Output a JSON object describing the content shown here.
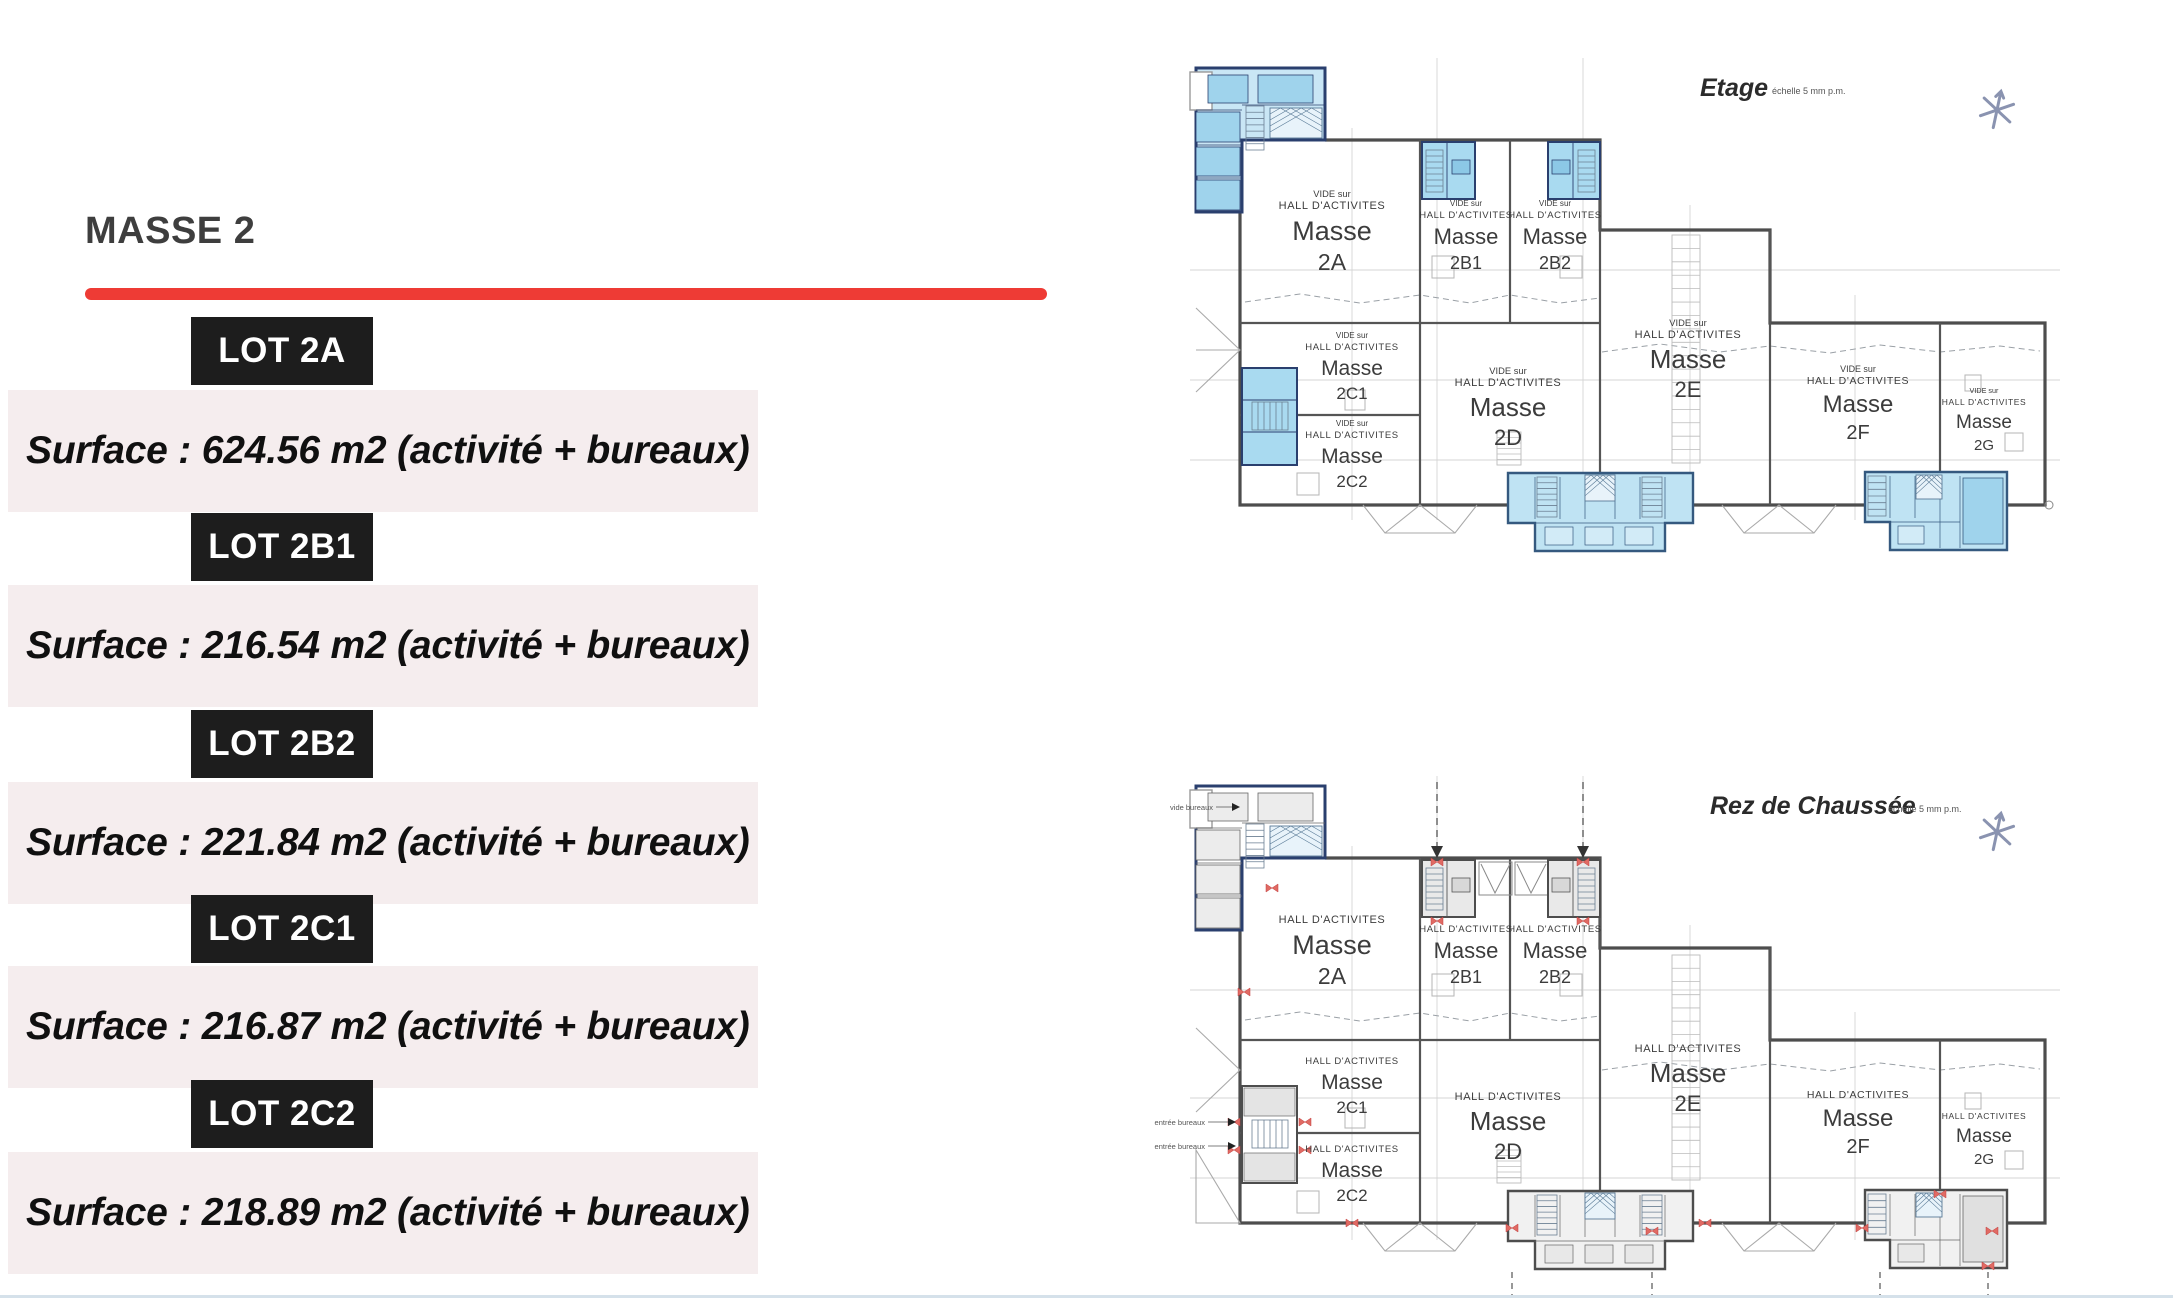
{
  "left_panel": {
    "title": "MASSE 2",
    "lots": [
      {
        "label": "LOT 2A",
        "surface": "Surface : 624.56 m2 (activité + bureaux)"
      },
      {
        "label": "LOT 2B1",
        "surface": "Surface : 216.54 m2 (activité + bureaux)"
      },
      {
        "label": "LOT 2B2",
        "surface": "Surface : 221.84 m2 (activité + bureaux)"
      },
      {
        "label": "LOT 2C1",
        "surface": "Surface : 216.87 m2 (activité + bureaux)"
      },
      {
        "label": "LOT 2C2",
        "surface": "Surface : 218.89 m2 (activité + bureaux)"
      }
    ],
    "colors": {
      "accent_red": "#ee3b35",
      "lot_bg": "#1d1d1d",
      "band_bg": "#f5edee"
    }
  },
  "plans": {
    "words": {
      "vide_prefix": "VIDE sur",
      "hall": "HALL D'ACTIVITES",
      "masse": "Masse"
    },
    "etage": {
      "title": "Etage",
      "scale_note": "échelle 5 mm p.m.",
      "rooms": [
        "2A",
        "2B1",
        "2B2",
        "2C1",
        "2C2",
        "2D",
        "2E",
        "2F",
        "2G"
      ]
    },
    "rdc": {
      "title": "Rez de Chaussée",
      "scale_note": "échelle 5 mm p.m.",
      "rooms": [
        "2A",
        "2B1",
        "2B2",
        "2C1",
        "2C2",
        "2D",
        "2E",
        "2F",
        "2G"
      ],
      "annotations": {
        "vide_bureaux": "vide bureaux",
        "entree_bureaux_1": "entrée bureaux",
        "entree_bureaux_2": "entrée bureaux"
      }
    },
    "colors": {
      "room_blue": "#a9daf0",
      "room_blue_light": "#c9e6f5",
      "wall_navy": "#2a3f6e",
      "wall_gray": "#4d4d4d",
      "marker_red": "#e06a63"
    }
  }
}
